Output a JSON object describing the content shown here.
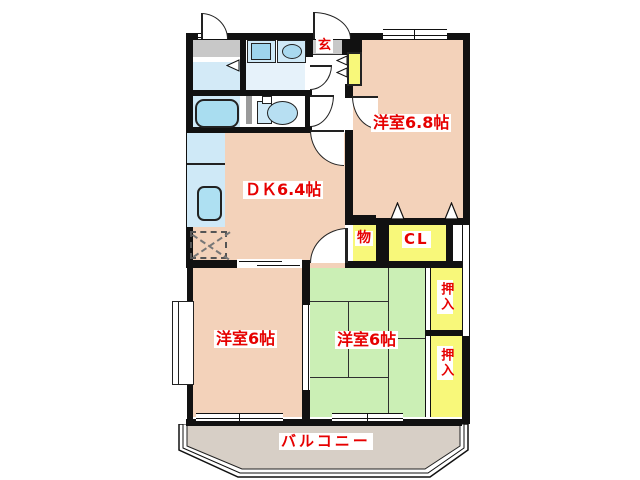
{
  "plan": {
    "type": "Japanese apartment floor plan",
    "labels": {
      "entrance": "玄",
      "dining_kitchen": "ＤＫ6.4帖",
      "bedroom_6_8": "洋室6.8帖",
      "storage": "物",
      "closet": "CL",
      "bedroom_6_left": "洋室6帖",
      "bedroom_6_center": "洋室6帖",
      "oshiire_upper": "押入",
      "oshiire_lower": "押入",
      "balcony": "バルコニー"
    },
    "colors": {
      "room_pink": "#f3d2ba",
      "tatami_green": "#cbefb5",
      "closet_yellow": "#f8f87a",
      "entry_gray": "#c8c8c8",
      "fixture_blue": "#cfe9f7",
      "balcony_beige": "#d7cfc6",
      "label_red": "#e60000",
      "wall_black": "#111111"
    }
  }
}
